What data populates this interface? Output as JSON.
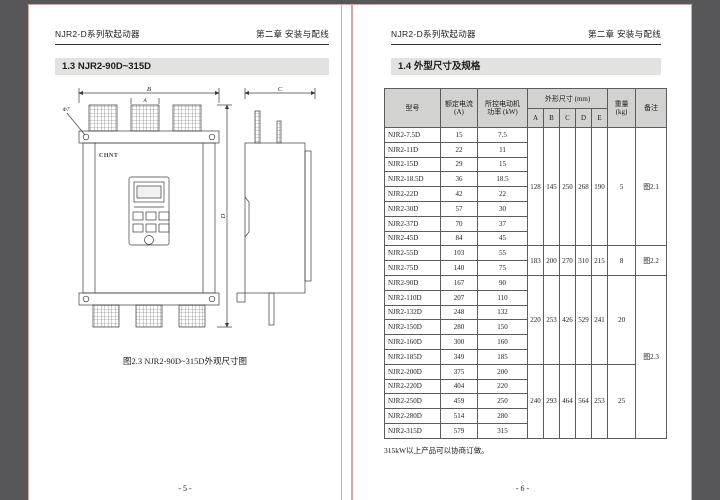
{
  "colors": {
    "canvas_bg": "#57575a",
    "page_bg": "#ffffff",
    "page_edge": "#dba49e",
    "section_bar_bg": "#e2e2de",
    "table_header_bg": "#d2d2d0",
    "drawing_line": "#3c3c3c",
    "text": "#1c1c1c"
  },
  "pages": {
    "left": {
      "header_left": "NJR2-D系列软起动器",
      "header_right": "第二章 安装与配线",
      "section_title": "1.3  NJR2-90D~315D",
      "figure_caption": "图2.3 NJR2-90D~315D外观尺寸图",
      "figure_labels": {
        "dim_b": "B",
        "dim_a": "A",
        "dim_c": "C",
        "dim_d": "D",
        "hole": "Φ7",
        "logo": "CHNT"
      },
      "page_number": "- 5 -"
    },
    "right": {
      "header_left": "NJR2-D系列软起动器",
      "header_right": "第二章 安装与配线",
      "section_title": "1.4  外型尺寸及规格",
      "footnote": "315kW以上产品可以协商订做。",
      "page_number": "- 6 -",
      "table": {
        "header": {
          "model": "型号",
          "current_l1": "额定电流",
          "current_l2": "(A)",
          "power_l1": "所控电动机",
          "power_l2": "功率 (kW)",
          "dims": "外形尺寸 (mm)",
          "dim_letters": [
            "A",
            "B",
            "C",
            "D",
            "E"
          ],
          "weight_l1": "重量",
          "weight_l2": "(kg)",
          "remark": "备注"
        },
        "rows": [
          [
            "NJR2-7.5D",
            "15",
            "7.5"
          ],
          [
            "NJR2-11D",
            "22",
            "11"
          ],
          [
            "NJR2-15D",
            "29",
            "15"
          ],
          [
            "NJR2-18.5D",
            "36",
            "18.5"
          ],
          [
            "NJR2-22D",
            "42",
            "22"
          ],
          [
            "NJR2-30D",
            "57",
            "30"
          ],
          [
            "NJR2-37D",
            "70",
            "37"
          ],
          [
            "NJR2-45D",
            "84",
            "45"
          ],
          [
            "NJR2-55D",
            "103",
            "55"
          ],
          [
            "NJR2-75D",
            "140",
            "75"
          ],
          [
            "NJR2-90D",
            "167",
            "90"
          ],
          [
            "NJR2-110D",
            "207",
            "110"
          ],
          [
            "NJR2-132D",
            "248",
            "132"
          ],
          [
            "NJR2-150D",
            "280",
            "150"
          ],
          [
            "NJR2-160D",
            "300",
            "160"
          ],
          [
            "NJR2-185D",
            "349",
            "185"
          ],
          [
            "NJR2-200D",
            "375",
            "200"
          ],
          [
            "NJR2-220D",
            "404",
            "220"
          ],
          [
            "NJR2-250D",
            "459",
            "250"
          ],
          [
            "NJR2-280D",
            "514",
            "280"
          ],
          [
            "NJR2-315D",
            "579",
            "315"
          ]
        ],
        "groups": [
          {
            "rows": 8,
            "dims": [
              "128",
              "145",
              "250",
              "268",
              "190"
            ],
            "weight": "5"
          },
          {
            "rows": 2,
            "dims": [
              "183",
              "200",
              "270",
              "310",
              "215"
            ],
            "weight": "8"
          },
          {
            "rows": 6,
            "dims": [
              "220",
              "253",
              "426",
              "529",
              "241"
            ],
            "weight": "20"
          },
          {
            "rows": 5,
            "dims": [
              "240",
              "293",
              "464",
              "564",
              "253"
            ],
            "weight": "25"
          }
        ],
        "remarks": [
          {
            "rows": 8,
            "text": "图2.1"
          },
          {
            "rows": 2,
            "text": "图2.2"
          },
          {
            "rows": 11,
            "text": "图2.3"
          }
        ]
      }
    }
  }
}
